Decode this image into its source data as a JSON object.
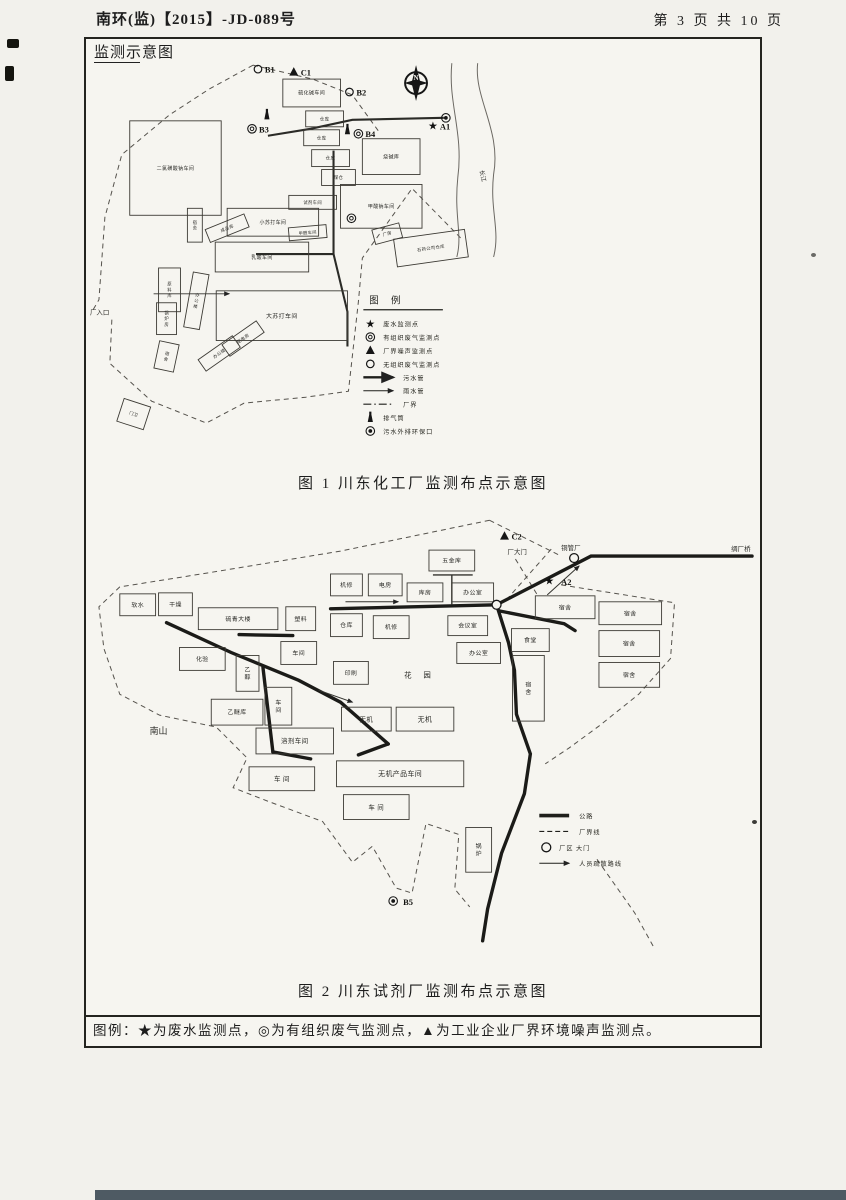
{
  "header": {
    "left": "南环(监)【2015】-JD-089号",
    "right": "第 3 页 共 10 页"
  },
  "title": "监测示意图",
  "footer_note": "图例：★为废水监测点，◎为有组织废气监测点，▲为工业企业厂界环境噪声监测点。",
  "fig1": {
    "caption": "图 1  川东化工厂监测布点示意图",
    "buildings": [
      [
        128,
        118,
        92,
        95,
        "二氯磺酸钠车间",
        5
      ],
      [
        282,
        76,
        58,
        28,
        "硫化碱车间",
        5
      ],
      [
        305,
        108,
        38,
        16,
        "仓库",
        4.5
      ],
      [
        303,
        127,
        36,
        16,
        "仓库",
        4.5
      ],
      [
        311,
        147,
        38,
        17,
        "仓库",
        4.5
      ],
      [
        321,
        167,
        34,
        16,
        "煤仓",
        4.5
      ],
      [
        362,
        136,
        58,
        36,
        "烧碱库",
        5
      ],
      [
        340,
        182,
        82,
        44,
        "甲酸钠车间",
        5
      ],
      [
        288,
        193,
        48,
        14,
        "试剂车间",
        4.3
      ],
      [
        226,
        206,
        92,
        28,
        "小苏打车间",
        5
      ],
      [
        214,
        240,
        94,
        30,
        "乳酸车间",
        5
      ],
      [
        288,
        224,
        38,
        13,
        "甲醛车间",
        4.2,
        -5
      ],
      [
        205,
        219,
        42,
        14,
        "成品库",
        4.3,
        -22
      ],
      [
        186,
        206,
        15,
        34,
        "宿舍",
        4.3,
        0,
        1
      ],
      [
        157,
        266,
        22,
        44,
        "原料库",
        4.3,
        0,
        1
      ],
      [
        187,
        271,
        16,
        56,
        "办公楼",
        4.3,
        10,
        1
      ],
      [
        155,
        301,
        20,
        32,
        "锅炉房",
        4.3,
        0,
        1
      ],
      [
        155,
        341,
        20,
        28,
        "宿舍",
        4.3,
        12,
        1
      ],
      [
        215,
        289,
        132,
        50,
        "大苏打车间",
        6
      ],
      [
        197,
        345,
        42,
        14,
        "办公楼",
        4.3,
        -35
      ],
      [
        221,
        330,
        42,
        14,
        "配电房",
        4.3,
        -35
      ],
      [
        118,
        401,
        28,
        24,
        "门卫",
        4.3,
        18
      ],
      [
        373,
        224,
        28,
        15,
        "厂房",
        4.3,
        -15
      ],
      [
        395,
        232,
        72,
        28,
        "石药公司仓库",
        4.3,
        -8
      ]
    ],
    "boundaries": [
      [
        [
          252,
          62
        ],
        [
          208,
          86
        ],
        [
          168,
          112
        ],
        [
          120,
          152
        ],
        [
          103,
          215
        ],
        [
          97,
          298
        ],
        [
          90,
          310
        ]
      ],
      [
        [
          110,
          318
        ],
        [
          108,
          362
        ],
        [
          150,
          400
        ],
        [
          205,
          422
        ],
        [
          243,
          402
        ],
        [
          305,
          396
        ],
        [
          348,
          390
        ],
        [
          358,
          300
        ],
        [
          362,
          256
        ],
        [
          412,
          186
        ],
        [
          463,
          238
        ]
      ],
      [
        [
          252,
          62
        ],
        [
          312,
          76
        ],
        [
          352,
          92
        ],
        [
          378,
          128
        ]
      ]
    ],
    "pipes": [
      [
        [
          333,
          148
        ],
        [
          333,
          252
        ],
        [
          347,
          310
        ],
        [
          347,
          345
        ]
      ],
      [
        [
          255,
          252
        ],
        [
          333,
          252
        ]
      ],
      [
        [
          267,
          133
        ],
        [
          310,
          126
        ],
        [
          352,
          117
        ],
        [
          444,
          115
        ]
      ]
    ],
    "arrows": [
      [
        [
          152,
          292
        ],
        [
          228,
          292
        ]
      ]
    ],
    "river": [
      "M452,60 C448,100 464,130 458,175 C454,215 463,232 457,255",
      "M478,60 C474,95 502,128 494,172 C490,208 501,228 494,255"
    ],
    "compass": {
      "x": 416,
      "y": 80,
      "label": "N"
    },
    "texts": [
      [
        88,
        313,
        "厂入口",
        6.5
      ],
      [
        480,
        168,
        "长江",
        6,
        78
      ]
    ],
    "markers": [
      {
        "s": "circle",
        "x": 257,
        "y": 66,
        "t": "B1"
      },
      {
        "s": "tri",
        "x": 293,
        "y": 69,
        "t": "C1"
      },
      {
        "s": "circle",
        "x": 349,
        "y": 89,
        "t": "B2"
      },
      {
        "s": "stack",
        "x": 266,
        "y": 112,
        "t": ""
      },
      {
        "s": "dcircle",
        "x": 251,
        "y": 126,
        "t": "B3"
      },
      {
        "s": "stack",
        "x": 347,
        "y": 127,
        "t": ""
      },
      {
        "s": "dcircle",
        "x": 358,
        "y": 131,
        "t": "B4"
      },
      {
        "s": "outfall",
        "x": 446,
        "y": 115,
        "t": ""
      },
      {
        "s": "star",
        "x": 433,
        "y": 123,
        "t": "A1"
      },
      {
        "s": "dcircle",
        "x": 351,
        "y": 216,
        "t": ""
      }
    ],
    "legend": {
      "x": 363,
      "y": 314,
      "rh": 13.5,
      "title": "图 例",
      "items": [
        {
          "k": "star",
          "t": "废水监测点"
        },
        {
          "k": "dcircle",
          "t": "有组织废气监测点"
        },
        {
          "k": "tri",
          "t": "厂界噪声监测点"
        },
        {
          "k": "circle",
          "t": "无组织废气监测点"
        },
        {
          "k": "pipe",
          "t": "污水管"
        },
        {
          "k": "rain",
          "t": "雨水管"
        },
        {
          "k": "bound",
          "t": "厂界"
        },
        {
          "k": "stack",
          "t": "排气筒"
        },
        {
          "k": "outfall",
          "t": "污水外排环保口"
        }
      ]
    }
  },
  "fig2": {
    "caption": "图 2 川东试剂厂监测布点示意图",
    "buildings": [
      [
        118,
        591,
        36,
        22,
        "软水",
        6
      ],
      [
        157,
        590,
        34,
        23,
        "干燥",
        6
      ],
      [
        197,
        605,
        80,
        22,
        "硫青大楼",
        6
      ],
      [
        285,
        604,
        30,
        24,
        "塑料",
        6
      ],
      [
        330,
        571,
        32,
        22,
        "机修",
        6
      ],
      [
        368,
        571,
        34,
        22,
        "电房",
        6
      ],
      [
        407,
        580,
        36,
        19,
        "库房",
        6
      ],
      [
        452,
        580,
        42,
        19,
        "办公室",
        6
      ],
      [
        429,
        547,
        46,
        21,
        "五金库",
        6
      ],
      [
        330,
        611,
        32,
        23,
        "仓库",
        6
      ],
      [
        373,
        613,
        36,
        23,
        "机修",
        6
      ],
      [
        448,
        613,
        40,
        20,
        "会议室",
        6
      ],
      [
        457,
        640,
        44,
        21,
        "办公室",
        6
      ],
      [
        536,
        593,
        60,
        23,
        "宿舍",
        6
      ],
      [
        600,
        599,
        63,
        23,
        "宿舍",
        6
      ],
      [
        600,
        628,
        61,
        26,
        "宿舍",
        6
      ],
      [
        600,
        660,
        61,
        25,
        "宿舍",
        6
      ],
      [
        512,
        626,
        38,
        23,
        "食堂",
        6
      ],
      [
        513,
        653,
        32,
        66,
        "宿舍",
        6,
        0,
        1
      ],
      [
        178,
        645,
        46,
        23,
        "化验",
        6
      ],
      [
        235,
        653,
        23,
        36,
        "乙醇",
        6,
        0,
        1
      ],
      [
        280,
        639,
        36,
        23,
        "车间",
        6
      ],
      [
        333,
        659,
        35,
        23,
        "印刷",
        6
      ],
      [
        210,
        697,
        52,
        26,
        "乙醚库",
        6
      ],
      [
        264,
        685,
        27,
        38,
        "车间",
        6,
        0,
        1
      ],
      [
        255,
        726,
        78,
        26,
        "溶剂车间",
        6.5
      ],
      [
        341,
        705,
        50,
        24,
        "无机",
        6.5
      ],
      [
        396,
        705,
        58,
        24,
        "无机",
        7
      ],
      [
        336,
        759,
        128,
        26,
        "无机产品车间",
        7
      ],
      [
        248,
        765,
        66,
        24,
        "车  间",
        6.5
      ],
      [
        343,
        793,
        66,
        25,
        "车  间",
        6.5
      ],
      [
        466,
        826,
        26,
        45,
        "锅炉",
        6,
        0,
        1
      ]
    ],
    "boundaries": [
      [
        [
          490,
          517
        ],
        [
          340,
          548
        ],
        [
          200,
          571
        ],
        [
          118,
          584
        ],
        [
          97,
          604
        ],
        [
          102,
          646
        ],
        [
          118,
          692
        ],
        [
          158,
          713
        ],
        [
          215,
          725
        ],
        [
          246,
          756
        ],
        [
          232,
          786
        ],
        [
          268,
          800
        ],
        [
          322,
          820
        ],
        [
          352,
          861
        ],
        [
          372,
          845
        ],
        [
          396,
          887
        ],
        [
          412,
          892
        ],
        [
          426,
          822
        ],
        [
          459,
          833
        ],
        [
          455,
          888
        ],
        [
          470,
          906
        ]
      ],
      [
        [
          562,
          582
        ],
        [
          676,
          600
        ],
        [
          672,
          656
        ],
        [
          640,
          692
        ],
        [
          600,
          724
        ],
        [
          570,
          746
        ],
        [
          546,
          762
        ]
      ],
      [
        [
          598,
          858
        ],
        [
          636,
          912
        ],
        [
          656,
          948
        ]
      ],
      [
        [
          490,
          517
        ],
        [
          532,
          538
        ],
        [
          562,
          553
        ]
      ],
      [
        [
          516,
          556
        ],
        [
          538,
          592
        ]
      ],
      [
        [
          552,
          546
        ],
        [
          506,
          598
        ]
      ]
    ],
    "roads": [
      [
        [
          754,
          553
        ],
        [
          592,
          553
        ],
        [
          497,
          602
        ]
      ],
      [
        [
          330,
          606
        ],
        [
          497,
          602
        ]
      ],
      [
        [
          497,
          602
        ],
        [
          509,
          640
        ],
        [
          515,
          668
        ],
        [
          517,
          712
        ],
        [
          531,
          752
        ],
        [
          525,
          792
        ],
        [
          502,
          852
        ],
        [
          488,
          908
        ],
        [
          483,
          940
        ]
      ],
      [
        [
          499,
          608
        ],
        [
          565,
          621
        ],
        [
          576,
          628
        ]
      ],
      [
        [
          165,
          620
        ],
        [
          230,
          650
        ],
        [
          298,
          678
        ],
        [
          340,
          700
        ],
        [
          388,
          742
        ]
      ],
      [
        [
          238,
          632
        ],
        [
          292,
          633
        ]
      ],
      [
        [
          262,
          665
        ],
        [
          272,
          750
        ]
      ],
      [
        [
          272,
          750
        ],
        [
          310,
          757
        ]
      ],
      [
        [
          388,
          742
        ],
        [
          358,
          753
        ]
      ]
    ],
    "lines": [
      [
        [
          433,
          572
        ],
        [
          473,
          572
        ]
      ],
      [
        [
          452,
          572
        ],
        [
          452,
          602
        ]
      ]
    ],
    "arrows": [
      [
        [
          345,
          599
        ],
        [
          398,
          599
        ]
      ],
      [
        [
          318,
          688
        ],
        [
          352,
          700
        ]
      ],
      [
        [
          548,
          592
        ],
        [
          580,
          563
        ]
      ]
    ],
    "gates": [
      {
        "x": 575,
        "y": 555
      },
      {
        "x": 497,
        "y": 602
      }
    ],
    "texts": [
      [
        404,
        675,
        "花  园",
        7.5,
        0,
        5
      ],
      [
        148,
        732,
        "南山",
        9
      ],
      [
        508,
        551,
        "厂大门",
        6.5
      ],
      [
        562,
        547,
        "铜管厂",
        6.5
      ],
      [
        733,
        548,
        "绸厂桥",
        6.5
      ]
    ],
    "markers": [
      {
        "s": "tri",
        "x": 505,
        "y": 533,
        "t": "C2"
      },
      {
        "s": "star",
        "x": 550,
        "y": 578,
        "t": "A2",
        "lx": 562,
        "ly": 582
      },
      {
        "s": "outfall",
        "x": 393,
        "y": 900,
        "t": "B5",
        "lx": 403,
        "ly": 904
      }
    ],
    "legend": {
      "x": 540,
      "y": 806,
      "rh": 16,
      "items": [
        {
          "k": "road",
          "t": "公路"
        },
        {
          "k": "dash",
          "t": "厂界线"
        },
        {
          "k": "gate",
          "t": "厂区  大门"
        },
        {
          "k": "arrow",
          "t": "人员疏散路线"
        }
      ]
    }
  }
}
